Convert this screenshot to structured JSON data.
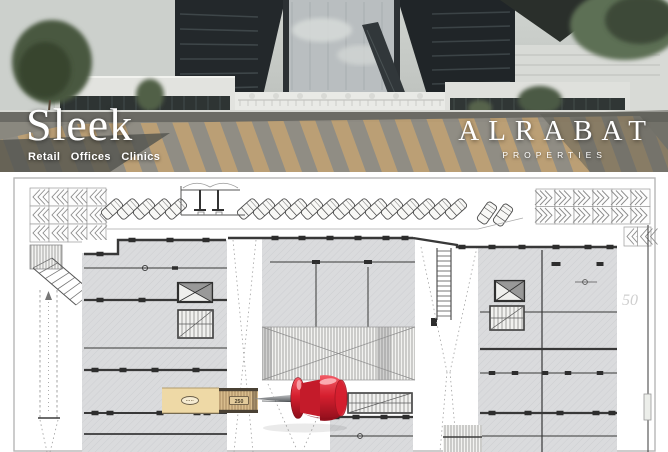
{
  "brand": {
    "name": "Sleek",
    "tagline": "Retail Offices Clinics",
    "developer": "ALRABAT",
    "developer_sub": "PROPERTIES"
  },
  "plan": {
    "unit_label": "250",
    "watermark_label": "50",
    "pin_icon": "red-pushpin-icon",
    "highlight_color": "#eed9a6",
    "stripe_tan": "#d9bd8d",
    "stripe_tan_line": "#a8895e",
    "pin_color": "#d61f2f",
    "pin_dark": "#8e0e1b",
    "pin_light": "#fdb6bb",
    "needle_color": "#8b8e91",
    "wall_color": "#383838",
    "room_fill": "#dadbdd",
    "hatch_line": "#cdced1",
    "frame_color": "#b7b7b7"
  },
  "photo": {
    "sky_color": "#c7cbc7",
    "building_dark": "#23282b",
    "glass_color": "#b9bec0",
    "terrace_color": "#e9eae6",
    "road_color": "#8a887f",
    "crosswalk_tan": "#c0a274",
    "tree_green": "#49593f"
  }
}
